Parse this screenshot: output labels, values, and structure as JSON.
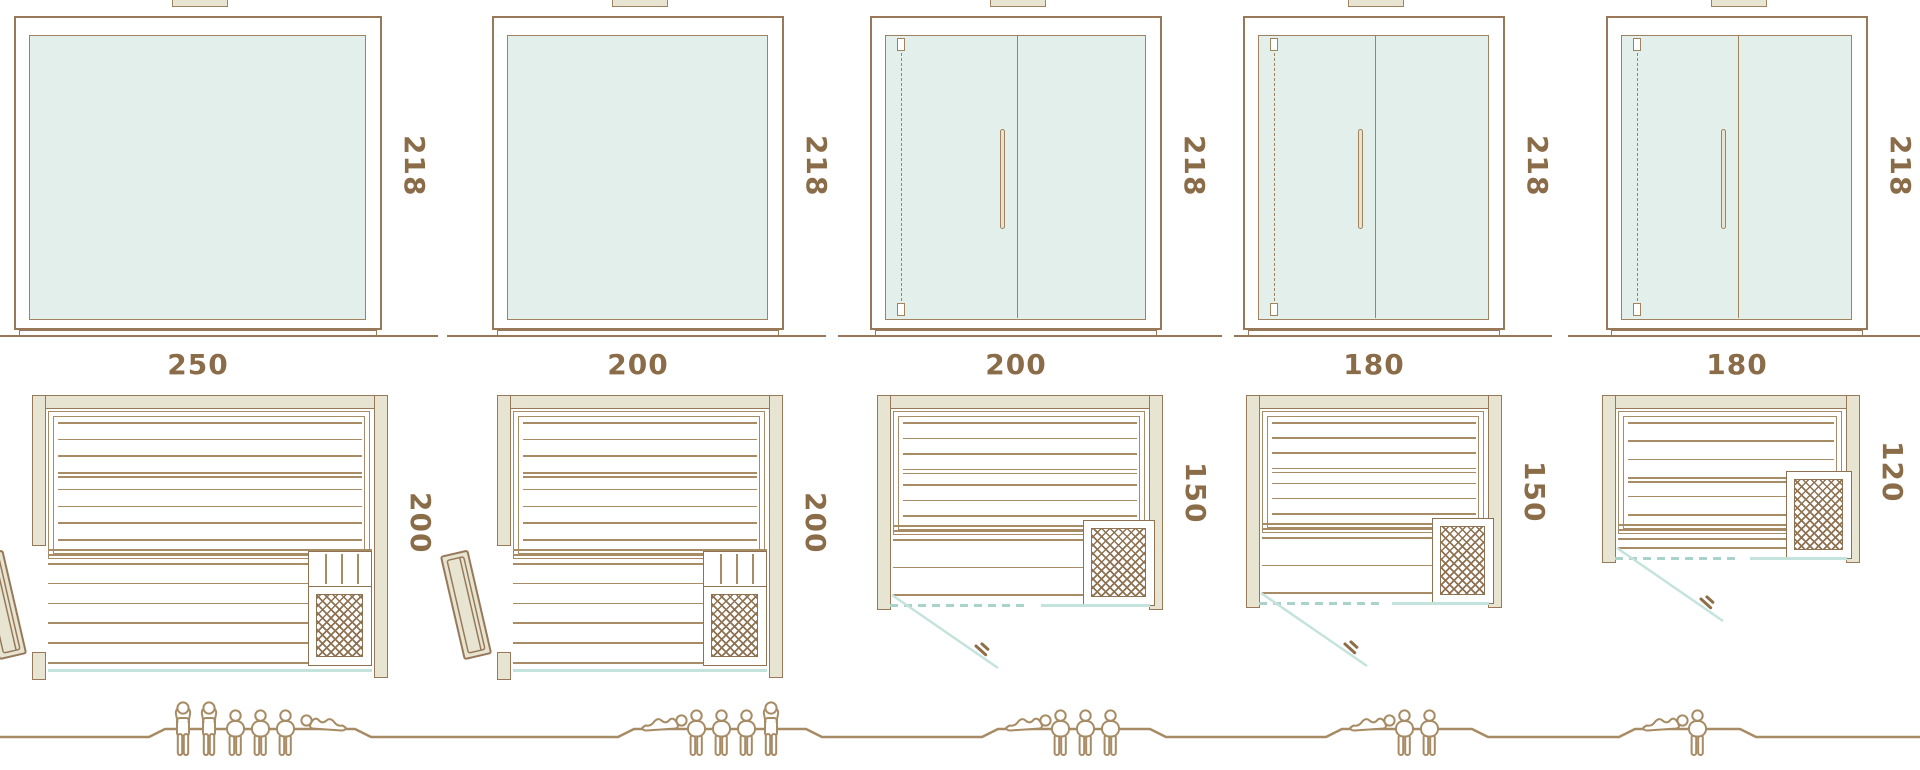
{
  "diagram": {
    "description": "Sauna model size comparison: five front elevations with glass fronts (top row), five floor plans with benches and corner heater (bottom row), and occupant capacity pictograms on a ground line (bottom strip).",
    "height_unit_label": "218"
  },
  "palette": {
    "line_brown": "#97795a",
    "slat_brown": "#a88c66",
    "text_brown": "#8b6c49",
    "wall_khaki": "#e7e5d2",
    "glass_mint": "#e2efeb",
    "glass_edge": "#a0825e",
    "door_cyan": "#c5e3dd",
    "door_cyan_dash": "#a9d3ca",
    "people_tan": "#a78b64",
    "heater_brown": "#8f7252"
  },
  "saunas": [
    {
      "name": "sauna-250-wide",
      "front_width": "250",
      "front_height": "218",
      "plan_depth": "200",
      "door_type": "side-hinged wood door",
      "heater": "corner heater bottom-right",
      "occupants": [
        "standing",
        "standing",
        "seated",
        "seated",
        "seated",
        "lying"
      ]
    },
    {
      "name": "sauna-200-wide-deep",
      "front_width": "200",
      "front_height": "218",
      "plan_depth": "200",
      "door_type": "side-hinged wood door",
      "heater": "corner heater bottom-right",
      "occupants": [
        "lying",
        "seated",
        "seated",
        "seated",
        "standing"
      ]
    },
    {
      "name": "sauna-200-wide-shallow",
      "front_width": "200",
      "front_height": "218",
      "plan_depth": "150",
      "door_type": "front glass door",
      "heater": "corner heater bottom-right",
      "occupants": [
        "lying",
        "seated",
        "seated",
        "seated"
      ]
    },
    {
      "name": "sauna-180-wide",
      "front_width": "180",
      "front_height": "218",
      "plan_depth": "150",
      "door_type": "front glass door",
      "heater": "corner heater bottom-right",
      "occupants": [
        "lying",
        "seated",
        "seated"
      ]
    },
    {
      "name": "sauna-180-wide-compact",
      "front_width": "180",
      "front_height": "218",
      "plan_depth": "120",
      "door_type": "front glass door",
      "heater": "side heater right",
      "occupants": [
        "lying",
        "seated"
      ]
    }
  ]
}
